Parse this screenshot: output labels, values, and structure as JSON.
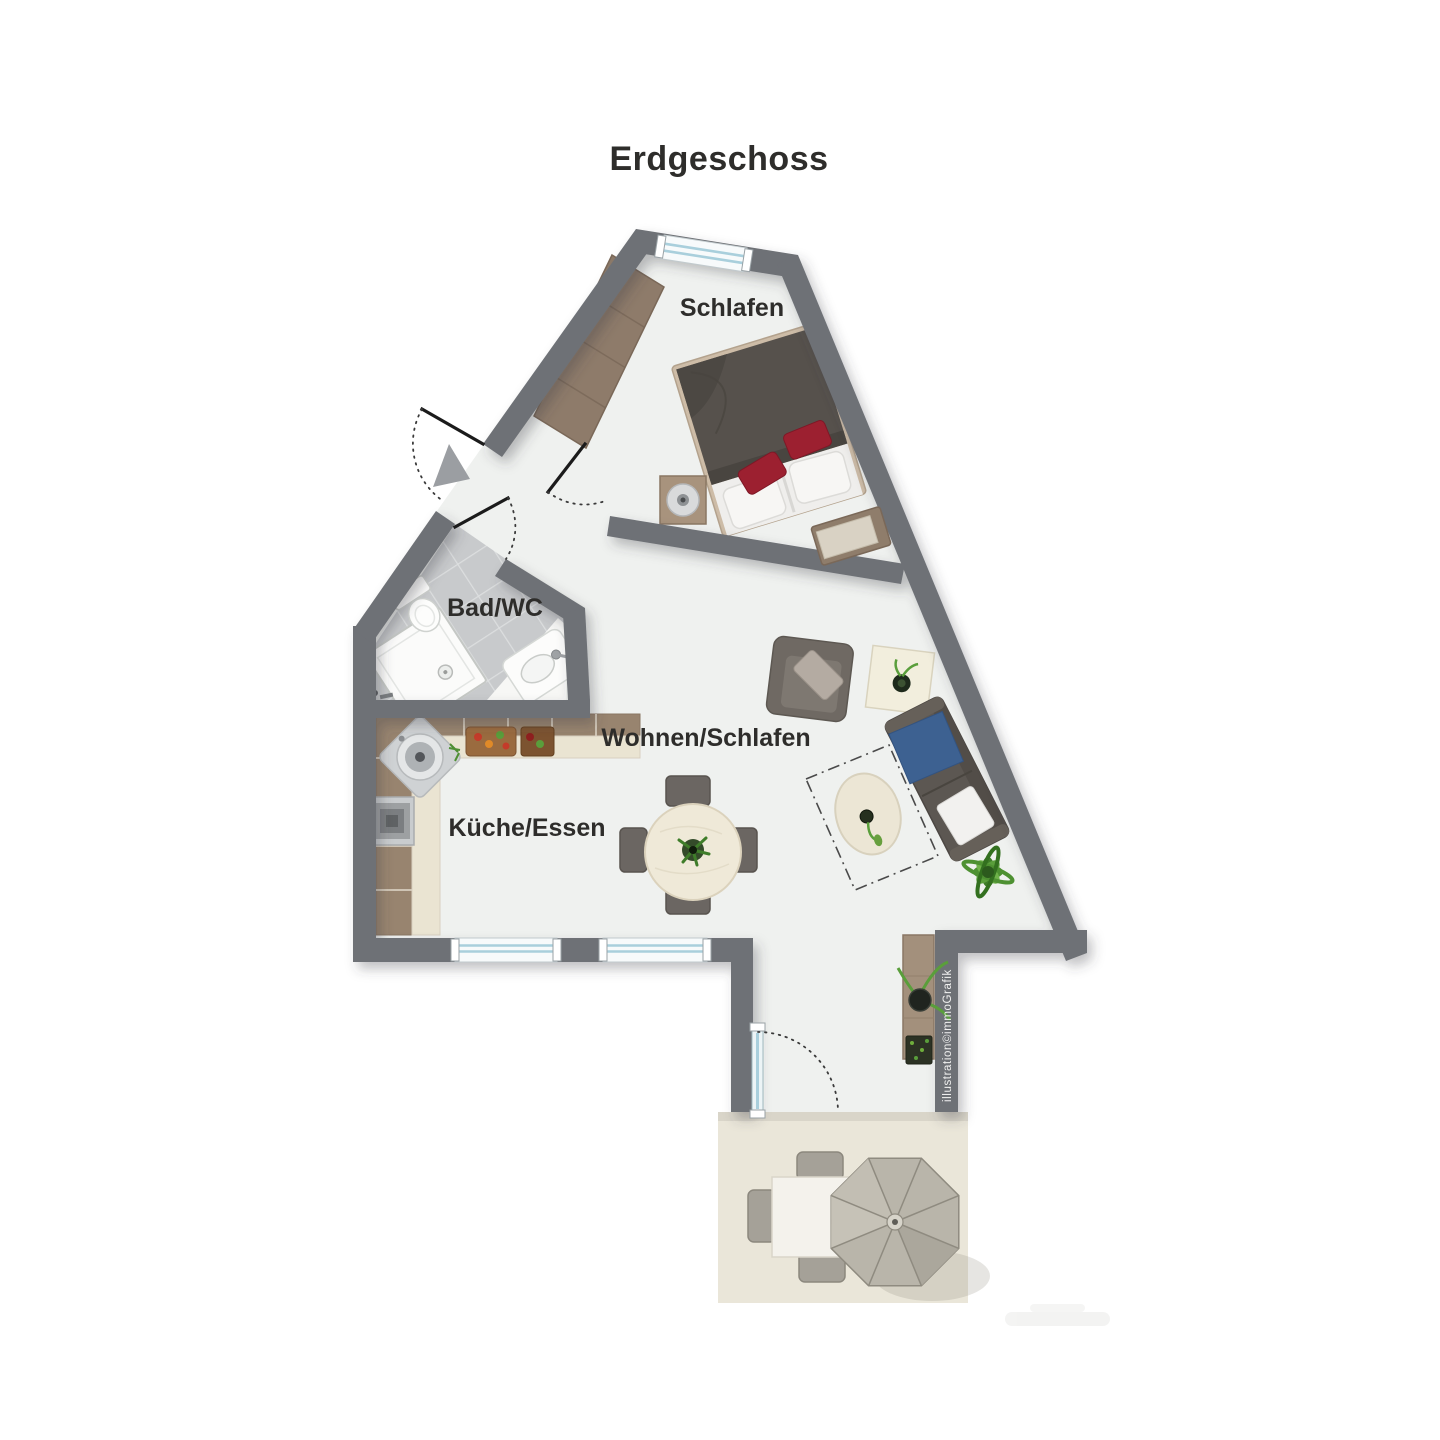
{
  "page": {
    "title": "Erdgeschoss"
  },
  "floor_plan": {
    "floor_label": "Erdgeschoss",
    "rooms": [
      {
        "label": "Schlafen"
      },
      {
        "label": "Bad/WC"
      },
      {
        "label": "Wohnen/Schlafen"
      },
      {
        "label": "Küche/Essen"
      }
    ],
    "watermark_vertical": "illustration©immoGrafik",
    "features": {
      "doors": [
        "entrance-door",
        "bath-door",
        "bedroom-door",
        "terrace-glass-door"
      ],
      "windows": [
        "bedroom-window",
        "kitchen-window-left",
        "kitchen-window-right"
      ],
      "furniture": [
        "wardrobe",
        "double-bed",
        "nightstand-lamp",
        "bench",
        "armchair",
        "side-table",
        "sofa",
        "coffee-table",
        "dining-table-4-chairs",
        "sideboard",
        "kitchen-counter",
        "stove",
        "kitchen-sink",
        "shower",
        "toilet",
        "bath-sink",
        "terrace-table",
        "terrace-chairs",
        "parasol"
      ]
    },
    "colors": {
      "wall": "#6e7176",
      "floor": "#eff1ef",
      "terrace": "#eae6d9",
      "tile": "#c8cacc",
      "tile_grout": "#dcdedf",
      "wood": "#8e7b6a",
      "counter_wood": "#98846f",
      "counter_cream": "#eae4d2",
      "bed_duvet": "#56514c",
      "bed_frame": "#cdbca7",
      "pillow_red": "#9c2030",
      "sofa": "#5c5752",
      "throw_blue": "#3d6191",
      "chair": "#6b6662",
      "table_cream": "#efe9d8",
      "plant": "#5a9e3b",
      "umbrella": "#b9b5aa",
      "window": "#a9cfdc",
      "text": "#2e2d2b",
      "watermark": "#f1f1f0"
    }
  }
}
